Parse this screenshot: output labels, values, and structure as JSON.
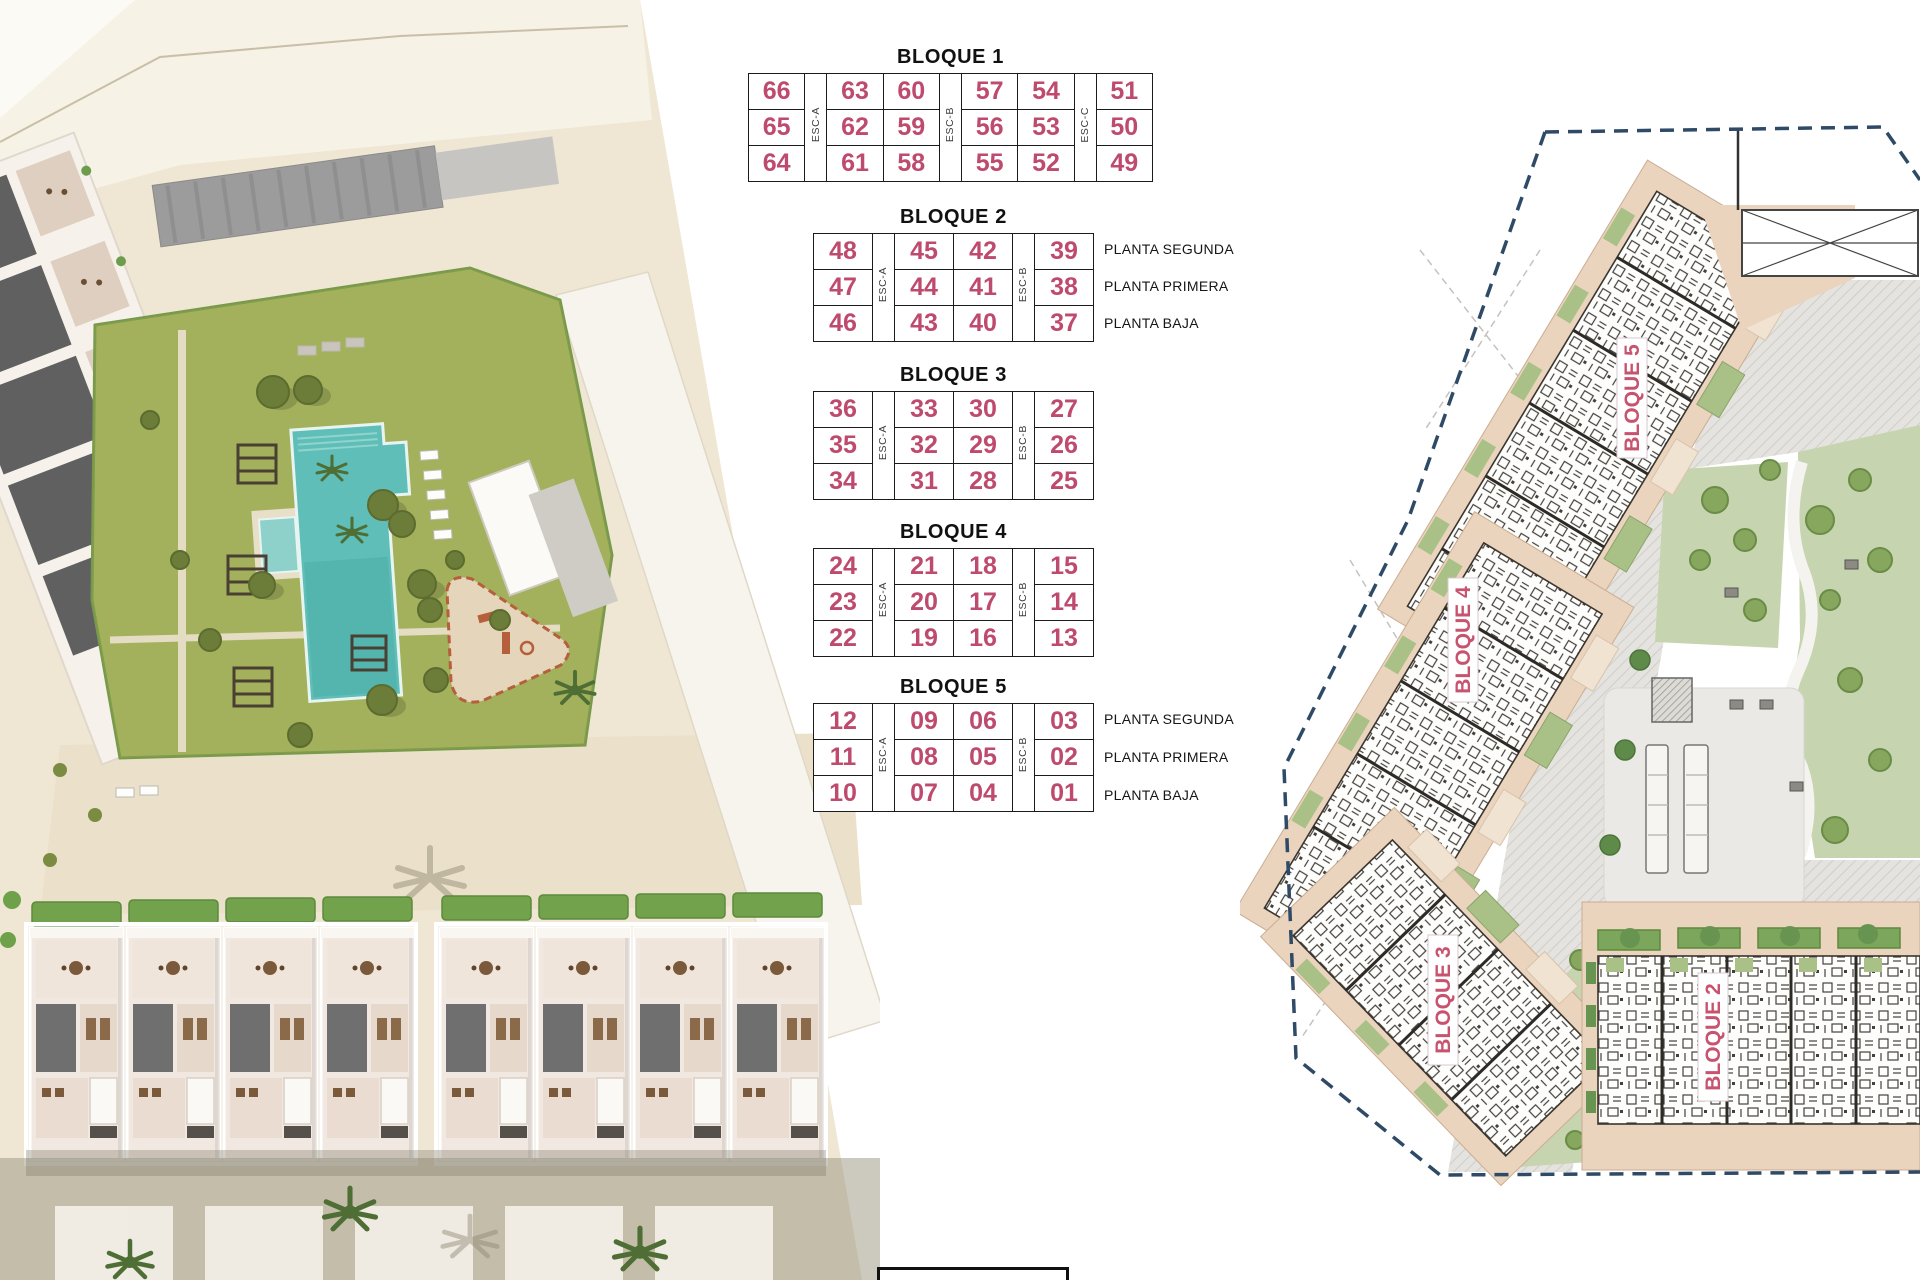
{
  "tables": [
    {
      "title": "BLOQUE 1",
      "esc_labels": [
        "ESC-A",
        "ESC-B",
        "ESC-C"
      ],
      "esc_after_col": [
        0,
        2,
        4
      ],
      "rows": [
        [
          "66",
          "63",
          "60",
          "57",
          "54",
          "51"
        ],
        [
          "65",
          "62",
          "59",
          "56",
          "53",
          "50"
        ],
        [
          "64",
          "61",
          "58",
          "55",
          "52",
          "49"
        ]
      ],
      "planta_labels": []
    },
    {
      "title": "BLOQUE 2",
      "esc_labels": [
        "ESC-A",
        "ESC-B"
      ],
      "esc_after_col": [
        0,
        2
      ],
      "rows": [
        [
          "48",
          "45",
          "42",
          "39"
        ],
        [
          "47",
          "44",
          "41",
          "38"
        ],
        [
          "46",
          "43",
          "40",
          "37"
        ]
      ],
      "planta_labels": [
        "PLANTA SEGUNDA",
        "PLANTA PRIMERA",
        "PLANTA BAJA"
      ]
    },
    {
      "title": "BLOQUE 3",
      "esc_labels": [
        "ESC-A",
        "ESC-B"
      ],
      "esc_after_col": [
        0,
        2
      ],
      "rows": [
        [
          "36",
          "33",
          "30",
          "27"
        ],
        [
          "35",
          "32",
          "29",
          "26"
        ],
        [
          "34",
          "31",
          "28",
          "25"
        ]
      ],
      "planta_labels": []
    },
    {
      "title": "BLOQUE 4",
      "esc_labels": [
        "ESC-A",
        "ESC-B"
      ],
      "esc_after_col": [
        0,
        2
      ],
      "rows": [
        [
          "24",
          "21",
          "18",
          "15"
        ],
        [
          "23",
          "20",
          "17",
          "14"
        ],
        [
          "22",
          "19",
          "16",
          "13"
        ]
      ],
      "planta_labels": []
    },
    {
      "title": "BLOQUE 5",
      "esc_labels": [
        "ESC-A",
        "ESC-B"
      ],
      "esc_after_col": [
        0,
        2
      ],
      "rows": [
        [
          "12",
          "09",
          "06",
          "03"
        ],
        [
          "11",
          "08",
          "05",
          "02"
        ],
        [
          "10",
          "07",
          "04",
          "01"
        ]
      ],
      "planta_labels": [
        "PLANTA SEGUNDA",
        "PLANTA PRIMERA",
        "PLANTA BAJA"
      ]
    }
  ],
  "plan": {
    "labels": [
      "BLOQUE 5",
      "BLOQUE 4",
      "BLOQUE 3",
      "BLOQUE 2"
    ]
  },
  "colors": {
    "unit_number": "#be4a6e",
    "plan_label": "#c8536f",
    "boundary": "#2e4a66",
    "table_border": "#1b1b1b",
    "pool": "#5fbfb8",
    "lawn": "#a6b45f",
    "sand": "#efe7d4",
    "building_beige": "#ead4bd",
    "park_green": "#c7d4b0"
  }
}
